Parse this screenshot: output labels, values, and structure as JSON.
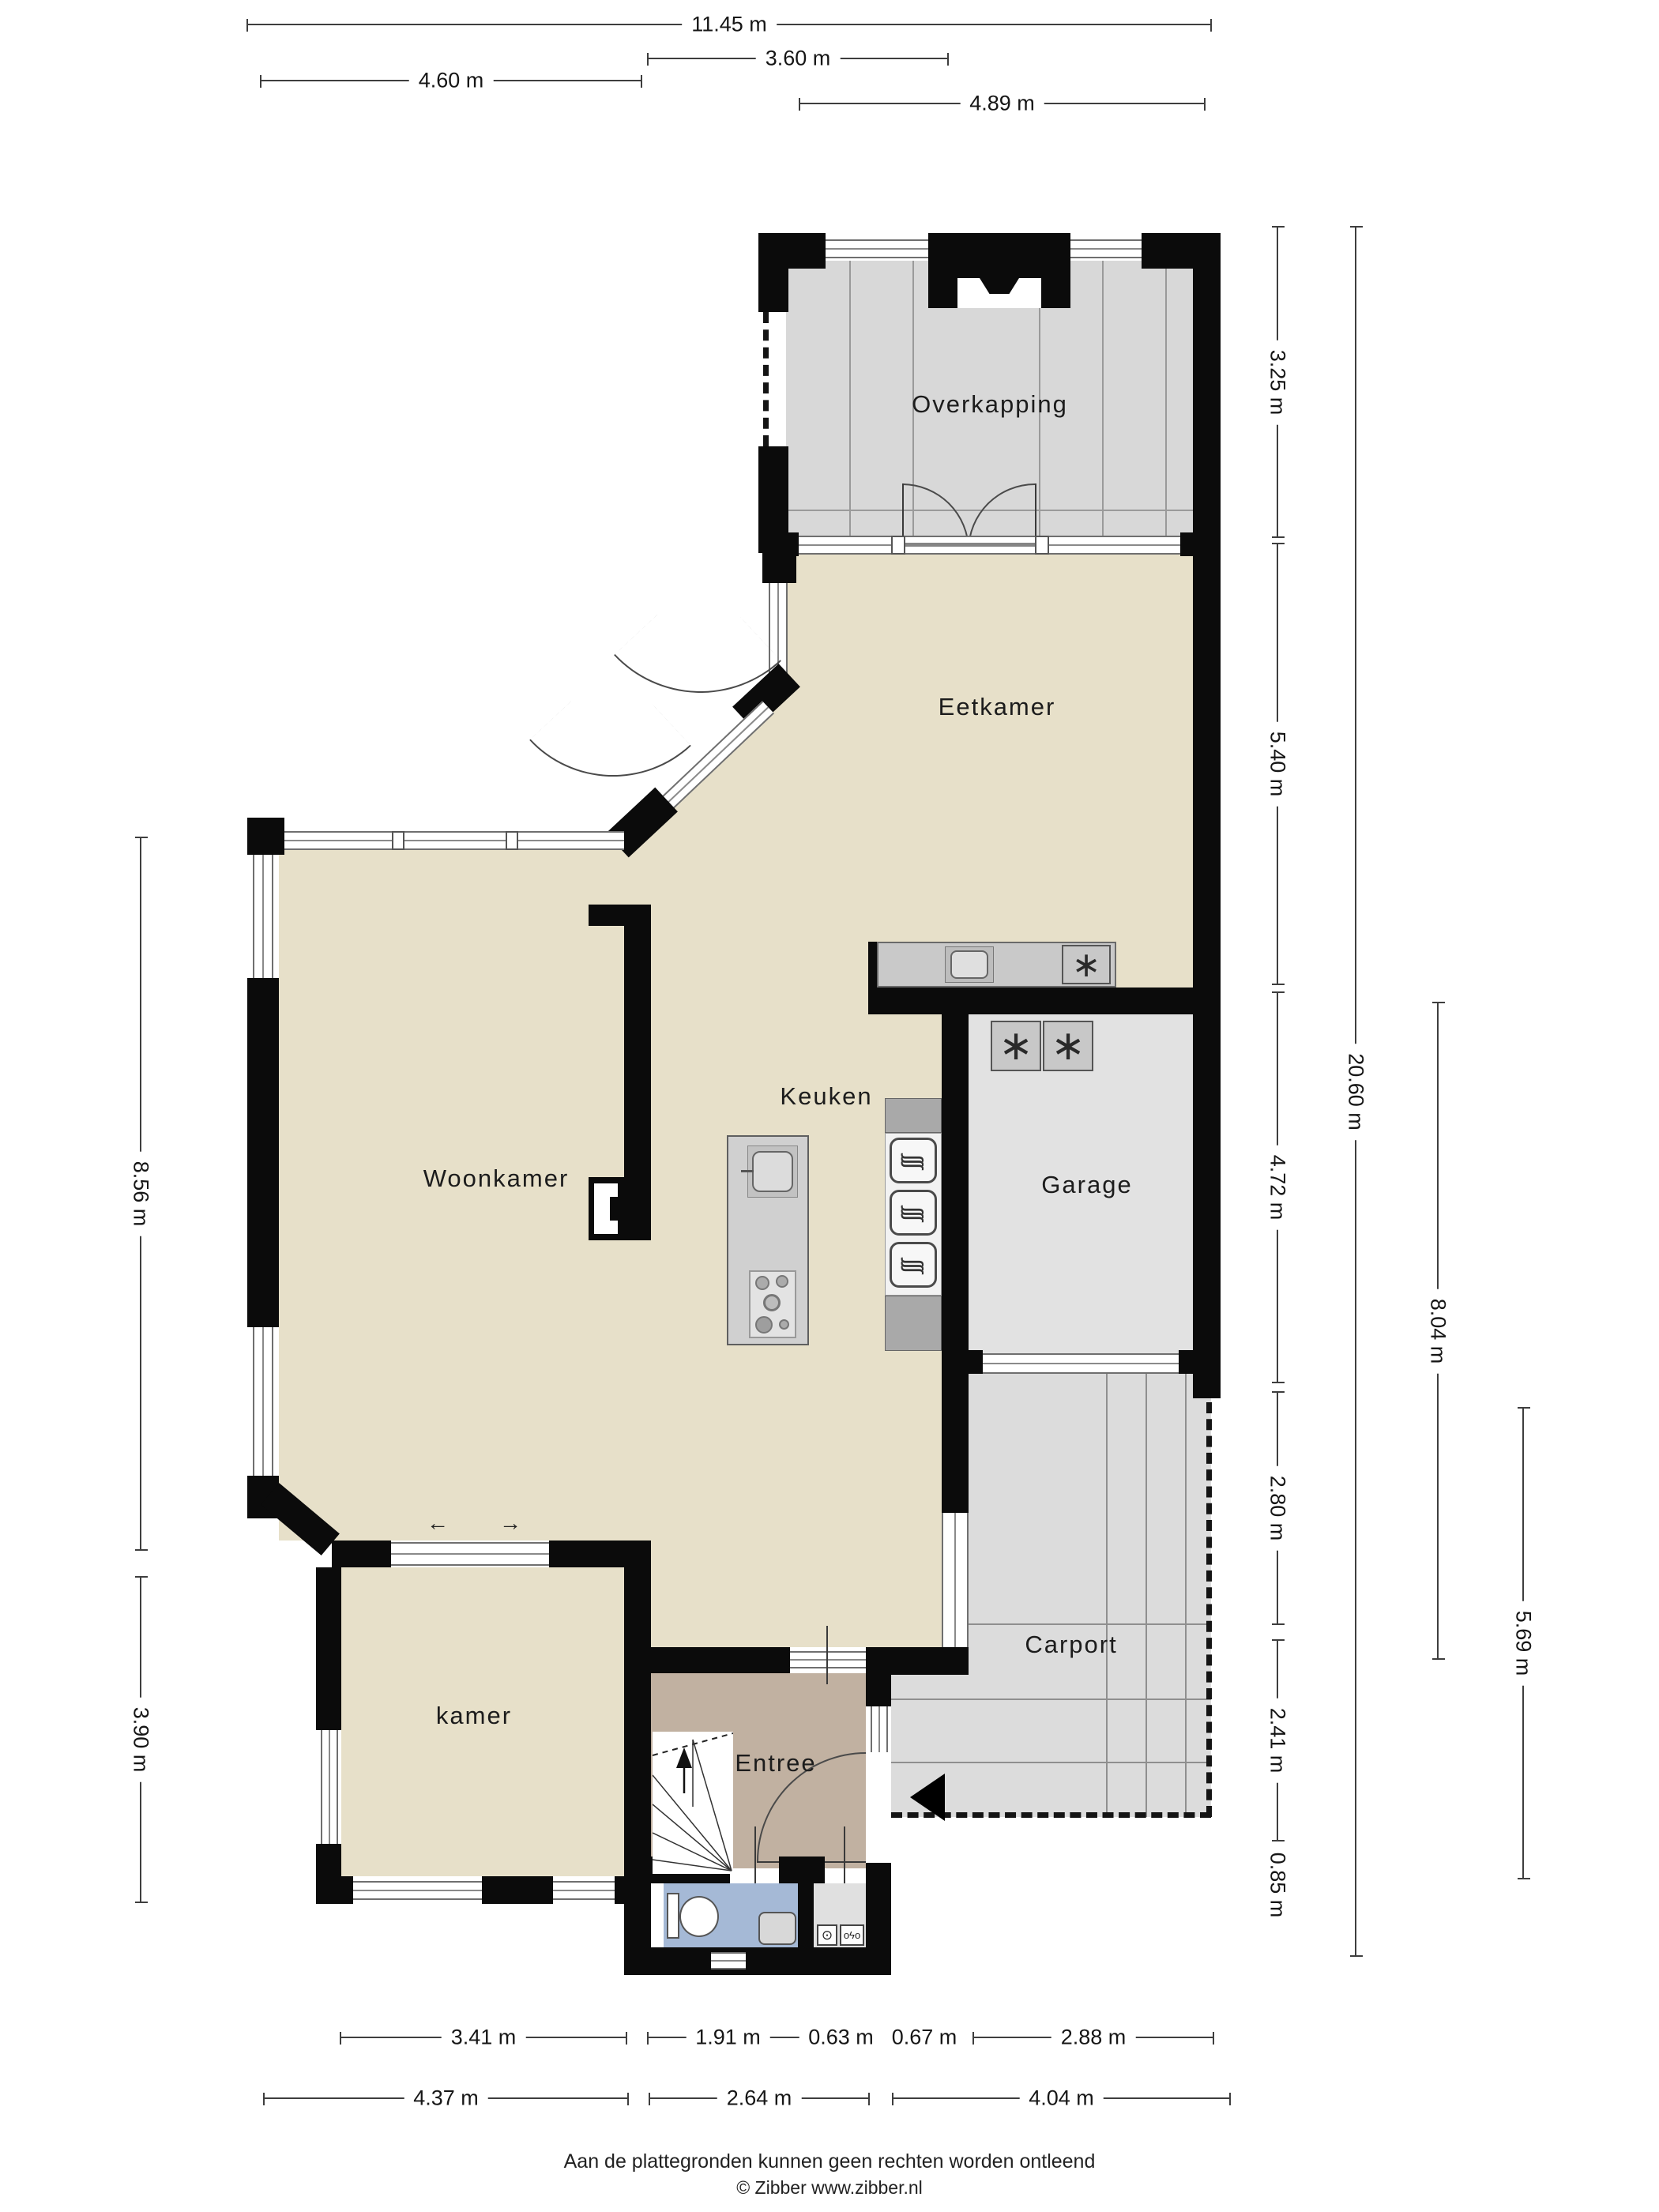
{
  "title": "Begane grond plattegrond",
  "rooms": {
    "overkapping": "Overkapping",
    "eetkamer": "Eetkamer",
    "woonkamer": "Woonkamer",
    "keuken": "Keuken",
    "garage": "Garage",
    "carport": "Carport",
    "kamer": "kamer",
    "entree": "Entree"
  },
  "dimensions": {
    "top": [
      {
        "label": "11.45 m"
      },
      {
        "label": "3.60 m"
      },
      {
        "label": "4.60 m"
      },
      {
        "label": "4.89 m"
      }
    ],
    "bottom": [
      {
        "label": "3.41 m"
      },
      {
        "label": "1.91 m"
      },
      {
        "label": "0.63 m"
      },
      {
        "label": "0.67 m"
      },
      {
        "label": "2.88 m"
      },
      {
        "label": "4.37 m"
      },
      {
        "label": "2.64 m"
      },
      {
        "label": "4.04 m"
      }
    ],
    "right": [
      {
        "label": "3.25 m"
      },
      {
        "label": "5.40 m"
      },
      {
        "label": "4.72 m"
      },
      {
        "label": "2.80 m"
      },
      {
        "label": "2.41 m"
      },
      {
        "label": "0.85 m"
      },
      {
        "label": "20.60 m"
      },
      {
        "label": "8.04 m"
      },
      {
        "label": "5.69 m"
      }
    ],
    "left": [
      {
        "label": "8.56 m"
      },
      {
        "label": "3.90 m"
      }
    ]
  },
  "glyphs": {
    "washer": "∗",
    "extractor": "∗",
    "oven": "∫∫∫",
    "arrow_left": "←",
    "arrow_right": "→",
    "water_meter": "⊙",
    "electric_meter": "oϟo"
  },
  "footer": {
    "line1": "Aan de plattegronden kunnen geen rechten worden ontleend",
    "line2": "© Zibber www.zibber.nl"
  },
  "colors": {
    "floor_beige": "#E7E0C9",
    "floor_gray": "#DCDCDC",
    "overkapping_gray": "#D8D8D8",
    "entree_taupe": "#C1B1A1",
    "toilet_blue": "#A5B9D6",
    "meter_gray": "#E0E0E0",
    "wall_black": "#0B0B0B"
  }
}
